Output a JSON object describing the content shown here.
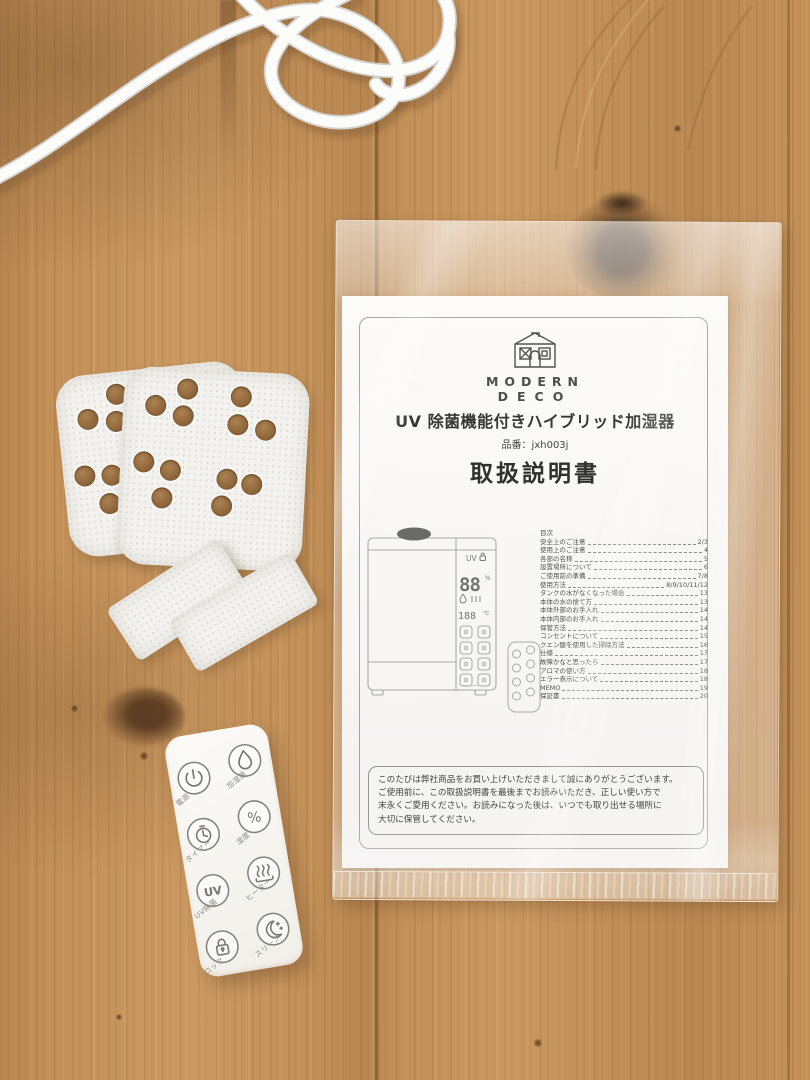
{
  "manual": {
    "brand": {
      "line1": "MODERN",
      "line2": "DECO"
    },
    "product_title": "UV 除菌機能付きハイブリッド加湿器",
    "model": "品番：jxh003j",
    "doc_title": "取扱説明書",
    "toc": {
      "header": "目次",
      "items": [
        {
          "label": "安全上のご注意",
          "page": "2/3"
        },
        {
          "label": "使用上のご注意",
          "page": "4"
        },
        {
          "label": "各部の名称",
          "page": "5"
        },
        {
          "label": "設置場所について",
          "page": "6"
        },
        {
          "label": "ご使用前の準備",
          "page": "7/8"
        },
        {
          "label": "使用方法",
          "page": "8/9/10/11/12"
        },
        {
          "label": "タンクの水がなくなった場合",
          "page": "13"
        },
        {
          "label": "本体の水の捨て方",
          "page": "13"
        },
        {
          "label": "本体外部のお手入れ",
          "page": "14"
        },
        {
          "label": "本体内部のお手入れ",
          "page": "14"
        },
        {
          "label": "保管方法",
          "page": "14"
        },
        {
          "label": "コンセントについて",
          "page": "15"
        },
        {
          "label": "クエン酸を使用した掃除方法",
          "page": "16"
        },
        {
          "label": "仕様",
          "page": "17"
        },
        {
          "label": "故障かなと思ったら",
          "page": "17"
        },
        {
          "label": "アロマの使い方",
          "page": "18"
        },
        {
          "label": "エラー表示について",
          "page": "18"
        },
        {
          "label": "MEMO",
          "page": "19"
        },
        {
          "label": "保証書",
          "page": "20"
        }
      ]
    },
    "illustration_display": {
      "uv": "UV",
      "humidity": "88",
      "humidity_unit": "%",
      "temp": "188",
      "temp_unit": "℃"
    },
    "notice_lines": [
      "このたびは弊社商品をお買い上げいただきまして誠にありがとうございます。",
      "ご使用前に、この取扱説明書を最後までお読みいただき、正しい使い方で",
      "末永くご愛用ください。お読みになった後は、いつでも取り出せる場所に",
      "大切に保管してください。"
    ]
  },
  "remote": {
    "buttons": [
      {
        "icon": "power-icon",
        "label": "電源"
      },
      {
        "icon": "mist-icon",
        "label": "加湿量"
      },
      {
        "icon": "timer-icon",
        "label": "タイマー"
      },
      {
        "icon": "humidity-icon",
        "label": "湿度",
        "icon_text": "%"
      },
      {
        "icon": "uv-icon",
        "label": "UV除菌",
        "icon_text": "UV"
      },
      {
        "icon": "heater-icon",
        "label": "ヒーター"
      },
      {
        "icon": "lock-icon",
        "label": "ロック"
      },
      {
        "icon": "sleep-icon",
        "label": "スリープ"
      }
    ]
  },
  "colors": {
    "wood_base": "#c39058",
    "wood_seam": "#7e5a36",
    "paper": "#fbfaf8",
    "remote_body": "#f7f5f1",
    "line_art": "#8f8f8a",
    "cable_white": "#fcfcfb"
  }
}
